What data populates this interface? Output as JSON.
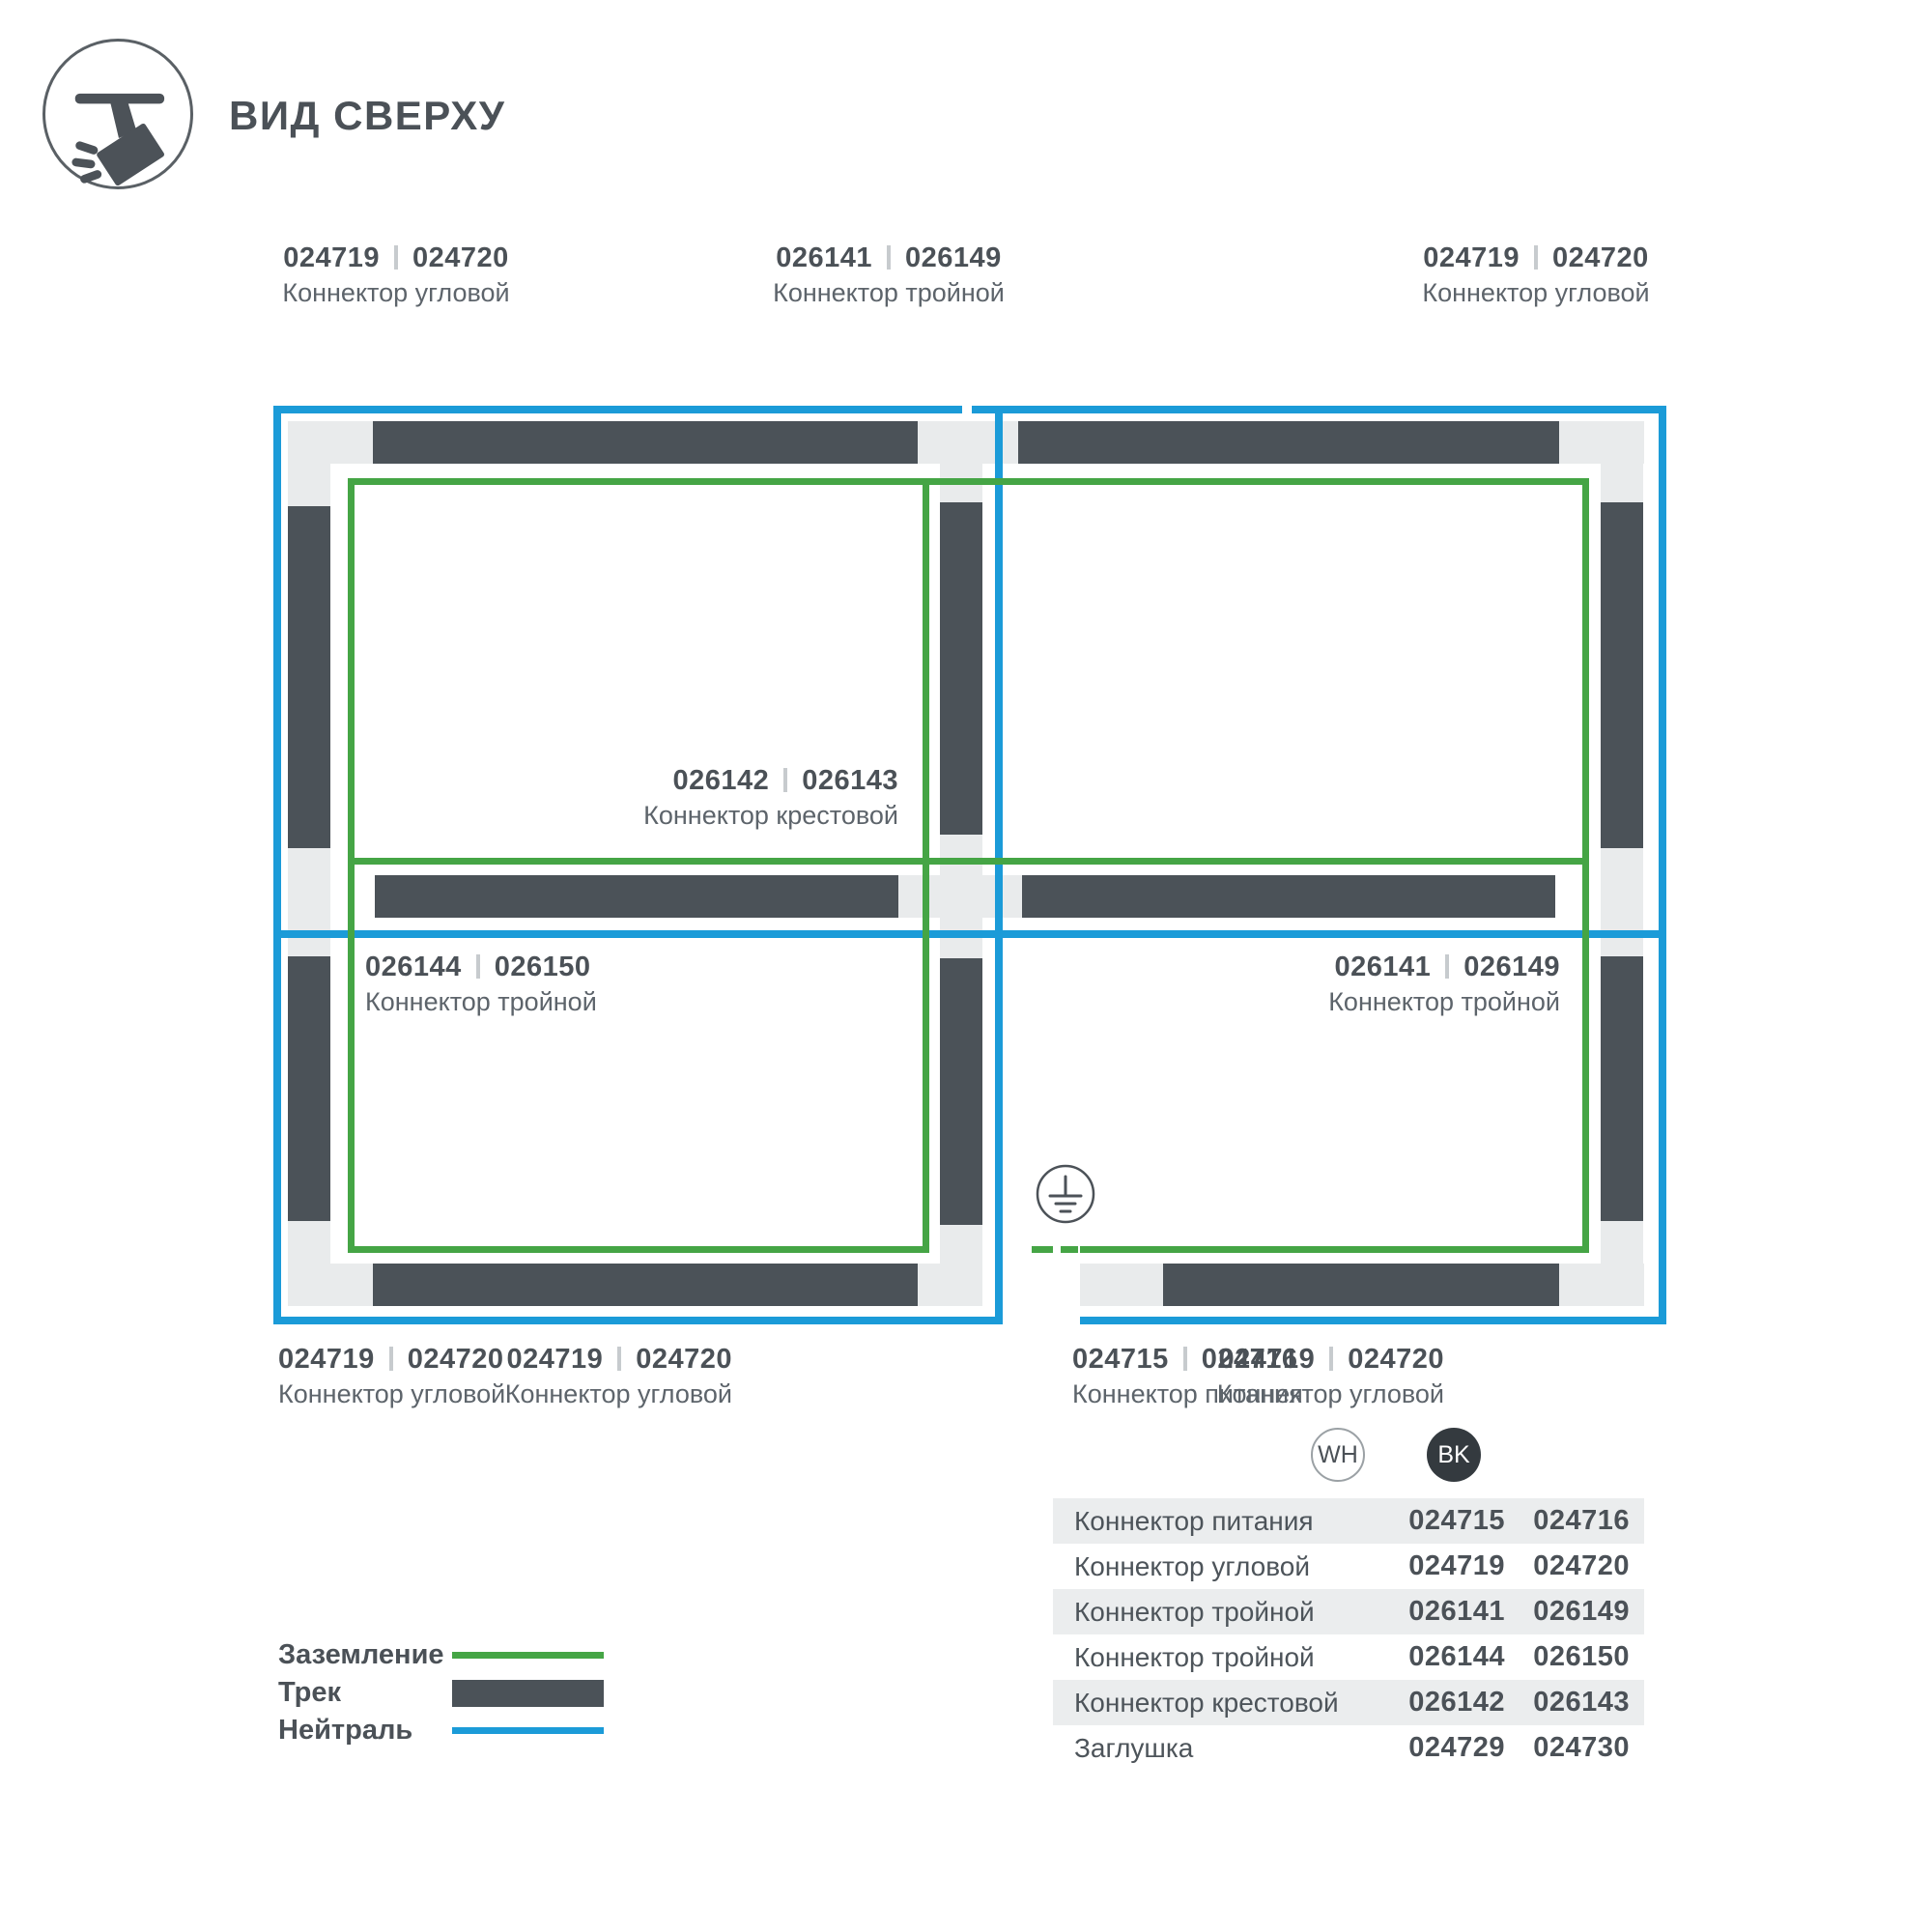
{
  "header": {
    "title": "ВИД СВЕРХУ",
    "icon": "track-spotlight-icon"
  },
  "colors": {
    "track": "#4b5258",
    "neutral": "#1b9bd8",
    "ground": "#45a545",
    "block": "#e9ebec",
    "row_bg": "#ebedee",
    "text": "#4b5157",
    "badge_bk_bg": "#343a3f"
  },
  "diagram_labels": [
    {
      "id": "top-left",
      "codes": [
        "024719",
        "024720"
      ],
      "name": "Коннектор угловой"
    },
    {
      "id": "top-middle",
      "codes": [
        "026141",
        "026149"
      ],
      "name": "Коннектор тройной"
    },
    {
      "id": "top-right",
      "codes": [
        "024719",
        "024720"
      ],
      "name": "Коннектор угловой"
    },
    {
      "id": "center-cross",
      "codes": [
        "026142",
        "026143"
      ],
      "name": "Коннектор крестовой"
    },
    {
      "id": "middle-left",
      "codes": [
        "026144",
        "026150"
      ],
      "name": "Коннектор тройной"
    },
    {
      "id": "middle-right",
      "codes": [
        "026141",
        "026149"
      ],
      "name": "Коннектор тройной"
    },
    {
      "id": "bottom-left",
      "codes": [
        "024719",
        "024720"
      ],
      "name": "Коннектор угловой"
    },
    {
      "id": "bottom-mid-left",
      "codes": [
        "024719",
        "024720"
      ],
      "name": "Коннектор угловой"
    },
    {
      "id": "bottom-power",
      "codes": [
        "024715",
        "024716"
      ],
      "name": "Коннектор питания"
    },
    {
      "id": "bottom-right",
      "codes": [
        "024719",
        "024720"
      ],
      "name": "Коннектор угловой"
    }
  ],
  "ground_symbol": {
    "icon": "earth-ground-icon"
  },
  "legend": [
    {
      "label": "Заземление",
      "type": "ground"
    },
    {
      "label": "Трек",
      "type": "track"
    },
    {
      "label": "Нейтраль",
      "type": "neutral"
    }
  ],
  "variant_badges": [
    {
      "code": "WH",
      "style": "white"
    },
    {
      "code": "BK",
      "style": "black"
    }
  ],
  "table": {
    "rows": [
      {
        "name": "Коннектор питания",
        "wh": "024715",
        "bk": "024716"
      },
      {
        "name": "Коннектор угловой",
        "wh": "024719",
        "bk": "024720"
      },
      {
        "name": "Коннектор тройной",
        "wh": "026141",
        "bk": "026149"
      },
      {
        "name": "Коннектор тройной",
        "wh": "026144",
        "bk": "026150"
      },
      {
        "name": "Коннектор крестовой",
        "wh": "026142",
        "bk": "026143"
      },
      {
        "name": "Заглушка",
        "wh": "024729",
        "bk": "024730"
      }
    ]
  }
}
